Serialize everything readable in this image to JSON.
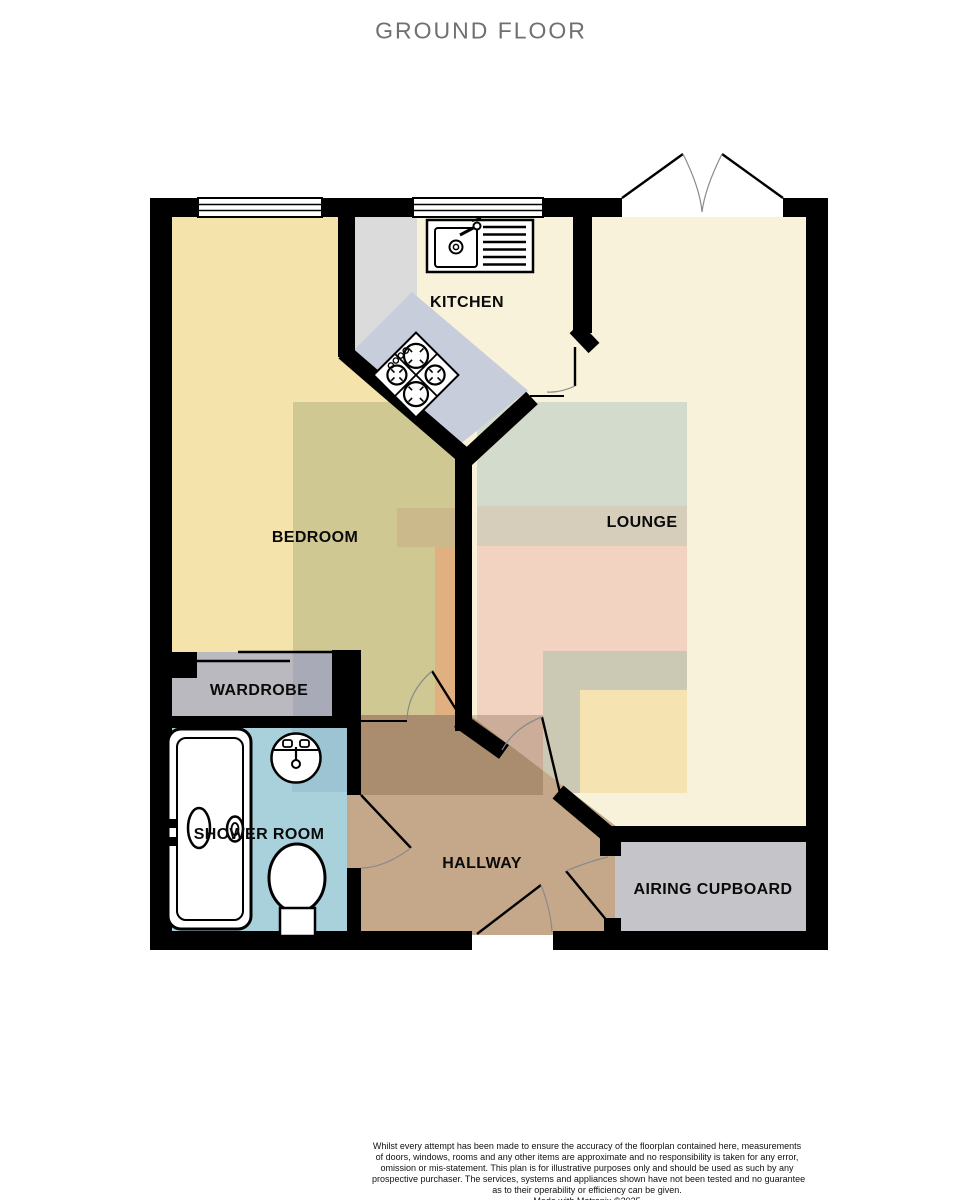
{
  "title": "GROUND FLOOR",
  "rooms": {
    "kitchen": {
      "label": "KITCHEN"
    },
    "bedroom": {
      "label": "BEDROOM"
    },
    "lounge": {
      "label": "LOUNGE"
    },
    "wardrobe": {
      "label": "WARDROBE"
    },
    "shower_room": {
      "label": "SHOWER ROOM"
    },
    "hallway": {
      "label": "HALLWAY"
    },
    "airing_cupboard": {
      "label": "AIRING CUPBOARD"
    }
  },
  "fixtures": [
    "kitchen-sink-drainer",
    "four-ring-hob",
    "bathtub",
    "basin",
    "toilet",
    "sliding-wardrobe-doors",
    "french-doors"
  ],
  "disclaimer": {
    "lines": [
      "Whilst every attempt has been made to ensure the accuracy of the floorplan contained here, measurements",
      "of doors, windows, rooms and any other items are approximate and no responsibility is taken for any error,",
      "omission or mis-statement. This plan is for illustrative purposes only and should be used as such by any",
      "prospective purchaser. The services, systems and appliances shown have not been tested and no guarantee",
      "as to their operability or efficiency can be given."
    ],
    "credit": "Made with Metropix ©2025"
  },
  "colors": {
    "wall": "#000000",
    "title": "#707070",
    "label": "#0a0a0a",
    "arc": "#8a8a8a",
    "bedroom": "#F5E3AC",
    "olive": "#CFC892",
    "olive_dark": "#CBB98B",
    "orange": "#E0B080",
    "cream": "#F8F2DA",
    "counter_gray": "#DCDBDB",
    "counter_blue": "#C8CDDB",
    "sage": "#D3DBCC",
    "tan": "#D6CDBB",
    "pink": "#F2D3C2",
    "khaki": "#CBC8B3",
    "pale_yellow": "#F5E4B2",
    "hallway": "#C5A88A",
    "shower": "#A9D1DC",
    "shower_dark": "#9CC4D3",
    "wardrobe": "#B9B9BF",
    "wardrobe_dark": "#A8ABB7",
    "cupboard": "#C5C4C9",
    "fixture": "#FFFFFF"
  }
}
